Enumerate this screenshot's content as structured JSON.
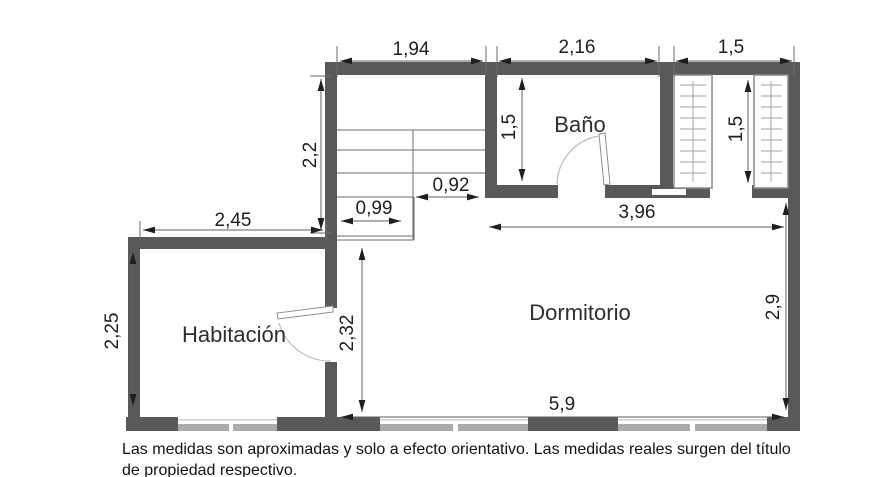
{
  "plan": {
    "rooms": {
      "habitacion": "Habitación",
      "dormitorio": "Dormitorio",
      "bano": "Baño"
    },
    "dims": {
      "top_left": "1,94",
      "top_mid": "2,16",
      "top_right": "1,5",
      "left": "2,2",
      "bano_height": "1,5",
      "closet_height": "1,5",
      "stair_right": "0,92",
      "stair_left": "0,99",
      "habitacion_width": "2,45",
      "habitacion_height": "2,25",
      "dormitorio_left": "2,32",
      "dormitorio_top": "3,96",
      "dormitorio_right": "2,9",
      "dormitorio_bottom": "5,9"
    }
  },
  "disclaimer": {
    "line1": "Las medidas son aproximadas y solo a efecto orientativo. Las medidas reales surgen del título",
    "line2": "de propiedad respectivo."
  },
  "colors": {
    "wall": "#58595b",
    "window": "#ababab",
    "dimension_line": "#5f5f5f",
    "text": "#1f1f1f"
  }
}
